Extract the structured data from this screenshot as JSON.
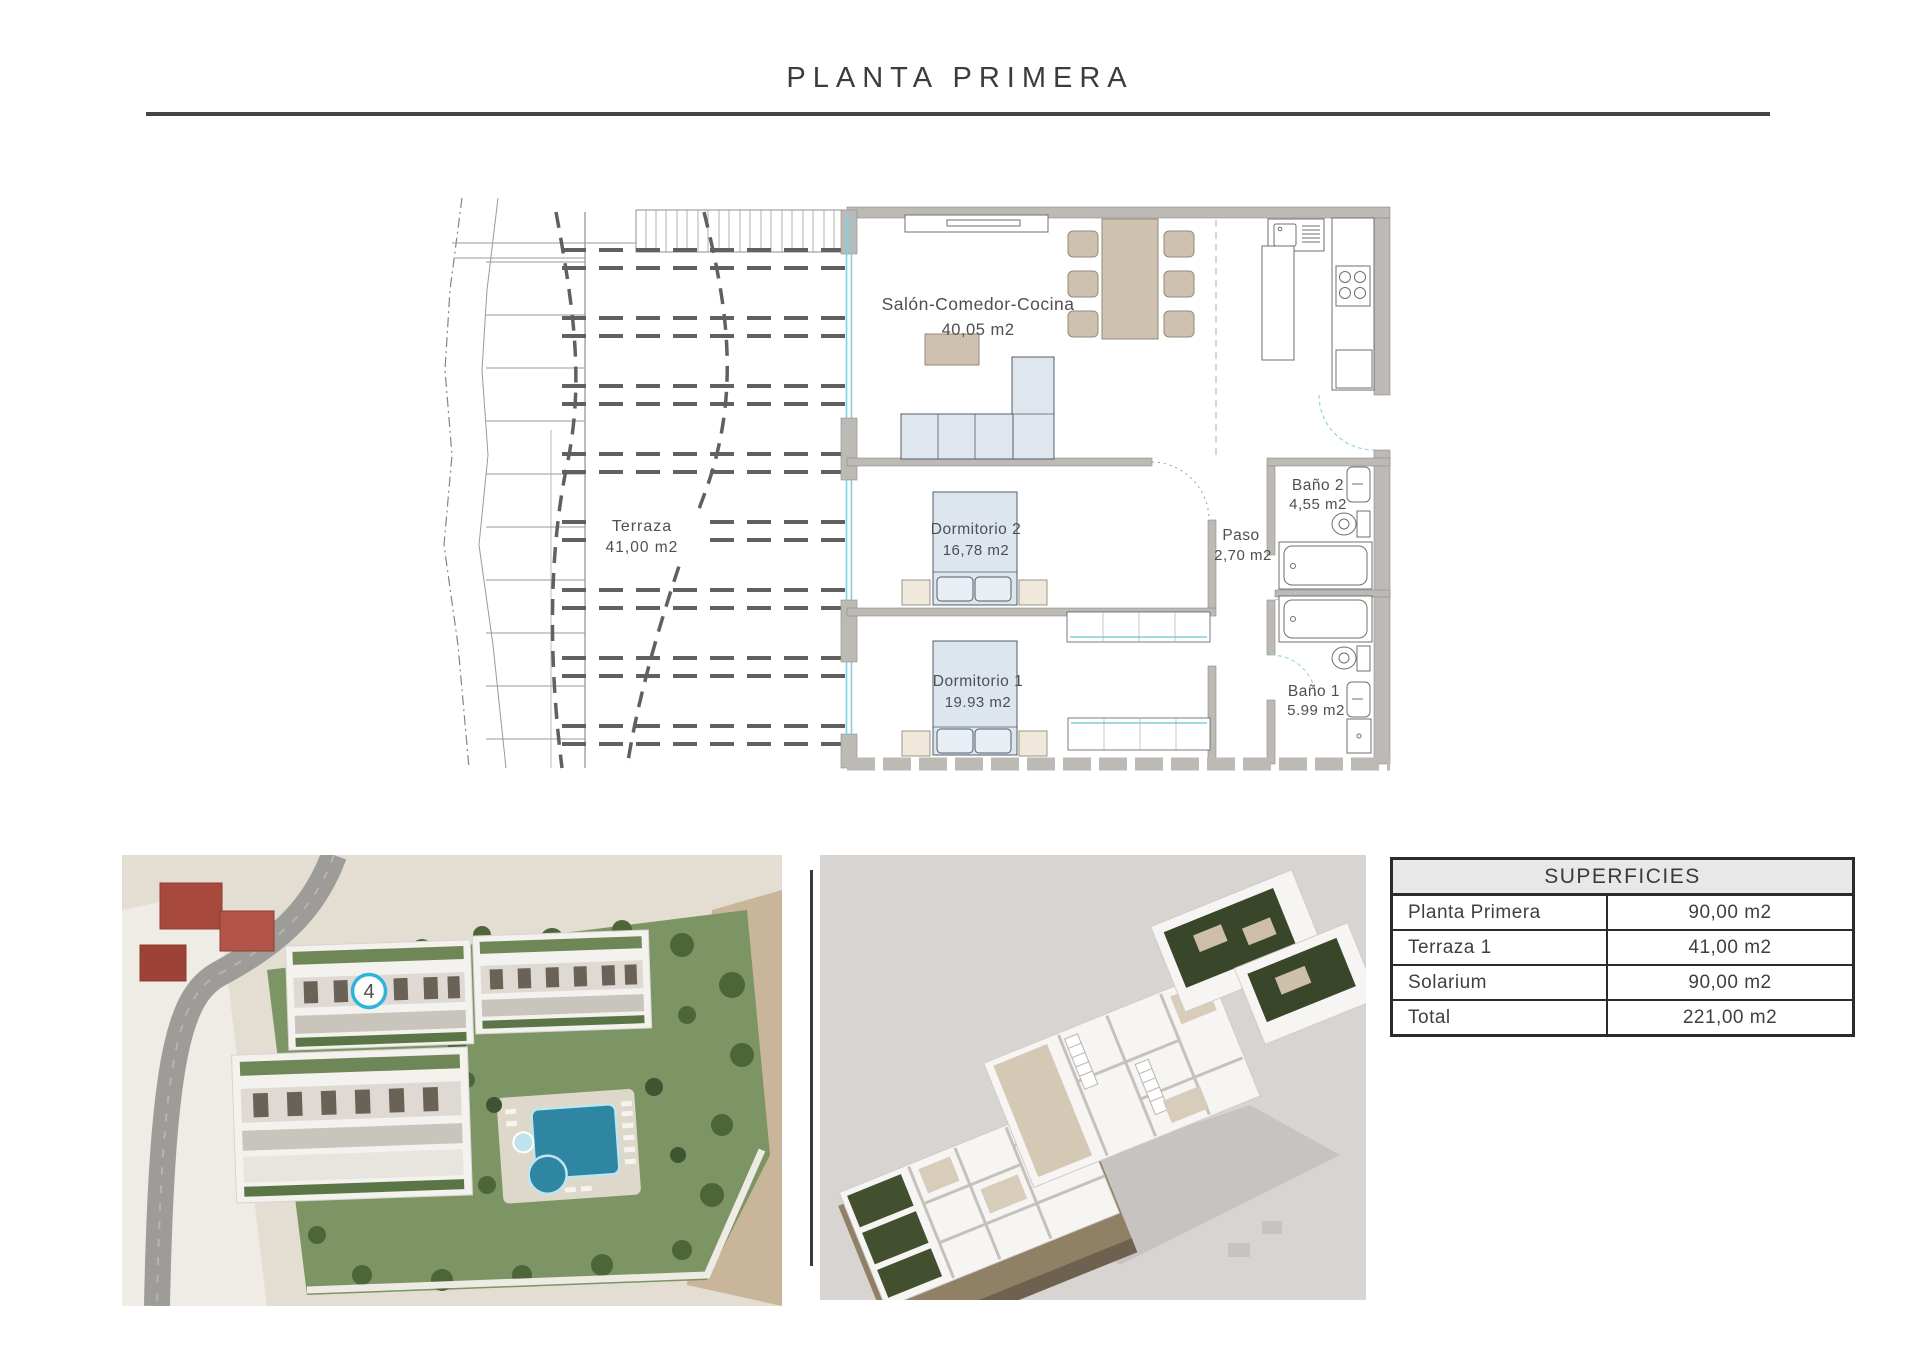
{
  "page": {
    "title": "PLANTA PRIMERA"
  },
  "floor_plan": {
    "rooms": {
      "salon": {
        "name": "Salón-Comedor-Cocina",
        "area": "40,05 m2"
      },
      "terraza": {
        "name": "Terraza",
        "area": "41,00 m2"
      },
      "dormitorio2": {
        "name": "Dormitorio 2",
        "area": "16,78 m2"
      },
      "dormitorio1": {
        "name": "Dormitorio 1",
        "area": "19.93 m2"
      },
      "paso": {
        "name": "Paso",
        "area": "2,70 m2"
      },
      "bano2": {
        "name": "Baño 2",
        "area": "4,55 m2"
      },
      "bano1": {
        "name": "Baño 1",
        "area": "5.99 m2"
      }
    }
  },
  "site_photo": {
    "unit_badge": "4"
  },
  "superficies_table": {
    "header": "SUPERFICIES",
    "rows": [
      {
        "label": "Planta Primera",
        "value": "90,00 m2"
      },
      {
        "label": "Terraza 1",
        "value": "41,00 m2"
      },
      {
        "label": "Solarium",
        "value": "90,00 m2"
      },
      {
        "label": "Total",
        "value": "221,00 m2"
      }
    ]
  },
  "colors": {
    "accent_cyan": "#2fb3d8",
    "wall_gray": "#bdbab6",
    "window_cyan": "#7fcfe2",
    "furniture_tan": "#cec1b0",
    "furniture_blue": "#dde5ef",
    "rule_dark": "#454545",
    "pool_teal": "#2f86a2"
  }
}
